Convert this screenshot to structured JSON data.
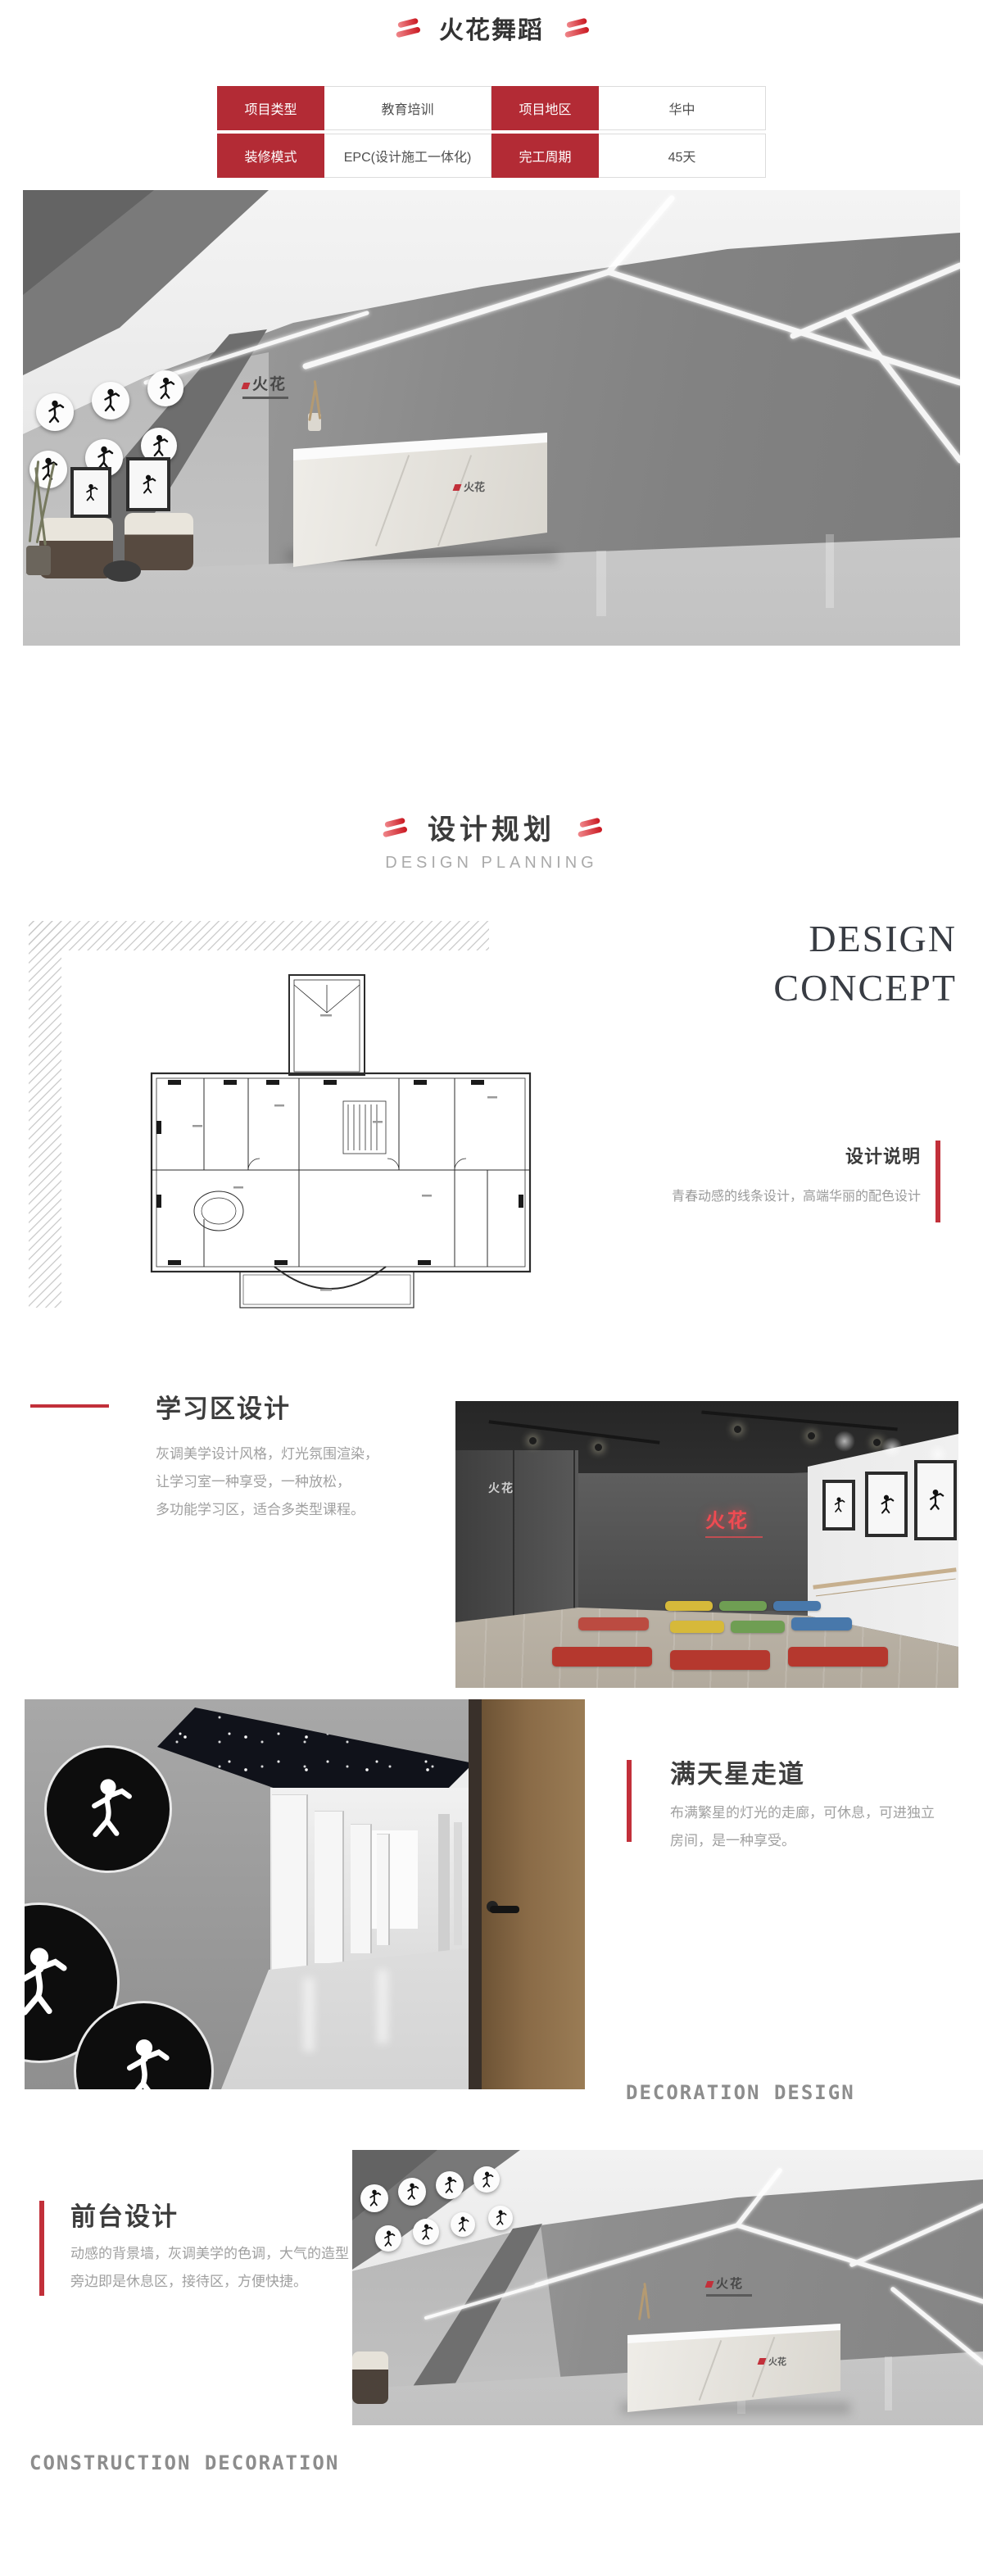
{
  "header": {
    "title": "火花舞蹈"
  },
  "info_table": {
    "rows": [
      {
        "cells": [
          {
            "v": "项目类型"
          },
          {
            "v": "教育培训"
          },
          {
            "v": "项目地区"
          },
          {
            "v": "华中"
          }
        ]
      },
      {
        "cells": [
          {
            "v": "装修模式"
          },
          {
            "v": "EPC(设计施工一体化)"
          },
          {
            "v": "完工周期"
          },
          {
            "v": "45天"
          }
        ]
      }
    ]
  },
  "planning": {
    "title": "设计规划",
    "subtitle": "DESIGN PLANNING"
  },
  "concept": {
    "big1": "DESIGN",
    "big2": "CONCEPT",
    "note_title": "设计说明",
    "note_text": "青春动感的线条设计，高端华丽的配色设计"
  },
  "learning": {
    "title": "学习区设计",
    "line1": "灰调美学设计风格，灯光氛围渲染，",
    "line2": "让学习室一种享受，一种放松，",
    "line3": "多功能学习区，适合多类型课程。"
  },
  "corridor": {
    "title": "满天星走道",
    "line1": "布满繁星的灯光的走廊，可休息，可进独立",
    "line2": "房间，是一种享受。"
  },
  "frontdesk": {
    "title": "前台设计",
    "line1": "动感的背景墙，灰调美学的色调，大气的造型",
    "line2": "旁边即是休息区，接待区，方便快捷。"
  },
  "footers": {
    "decoration": "DECORATION DESIGN",
    "construction": "CONSTRUCTION DECORATION"
  },
  "brand": {
    "logo": "火花"
  },
  "colors": {
    "accent_red": "#b32b35",
    "bar_red": "#c2303a",
    "heading_dark": "#3d3d3d",
    "body_gray": "#a0a0a0"
  }
}
